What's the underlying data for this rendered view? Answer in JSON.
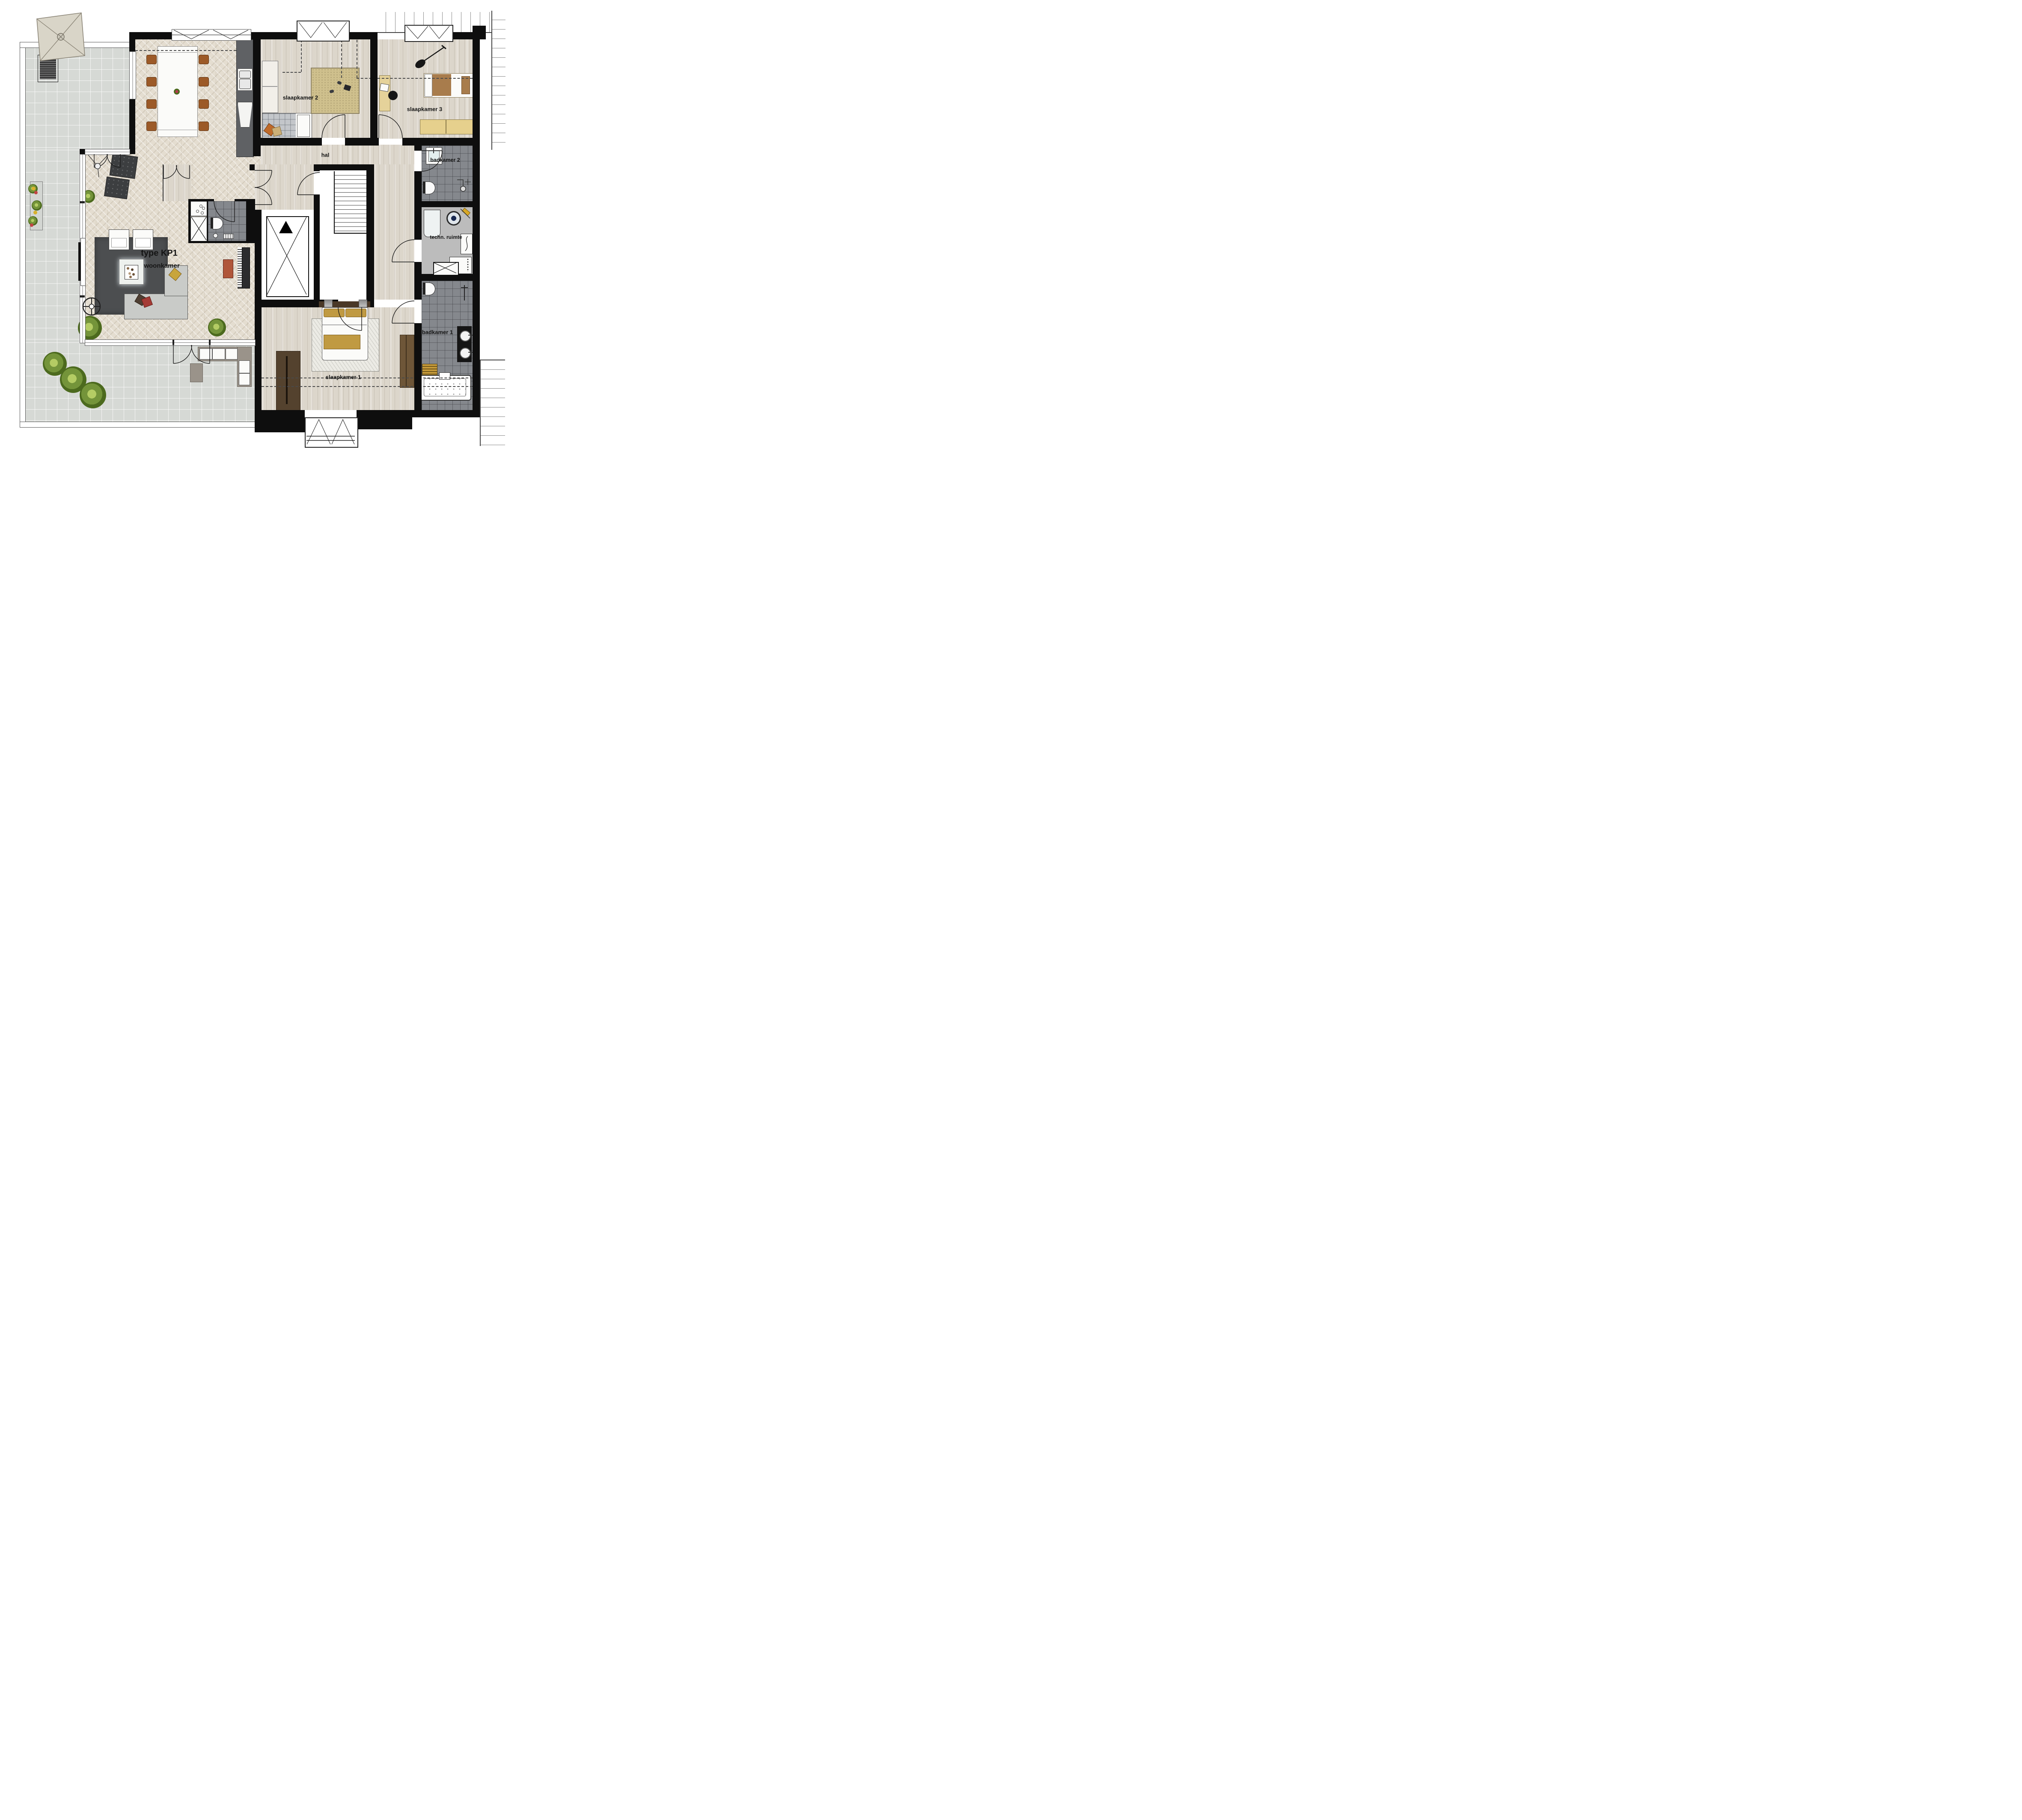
{
  "plan": {
    "type_label": "type KP1",
    "rooms": {
      "woonkamer": {
        "label": "woonkamer"
      },
      "hal": {
        "label": "hal"
      },
      "slaapkamer1": {
        "label": "slaapkamer 1"
      },
      "slaapkamer2": {
        "label": "slaapkamer 2"
      },
      "slaapkamer3": {
        "label": "slaapkamer 3"
      },
      "badkamer1": {
        "label": "badkamer 1"
      },
      "badkamer2": {
        "label": "badkamer 2"
      },
      "techniek": {
        "label": "techn. ruimte"
      }
    },
    "palette": {
      "wall": "#0e0e0e",
      "herringbone_floor": "#e4ddd0",
      "plank_floor": "#dcd6cb",
      "terrace_tile": "#d6d9d5",
      "bath_tile": "#85888d",
      "technical_floor": "#bcbcbc",
      "living_rug": "#4c4e50",
      "tan_rug": "#cfc08d",
      "accent_gold": "#c09a42",
      "chair_brown": "#9c5a28",
      "wardrobe_brown": "#6e5638"
    }
  }
}
